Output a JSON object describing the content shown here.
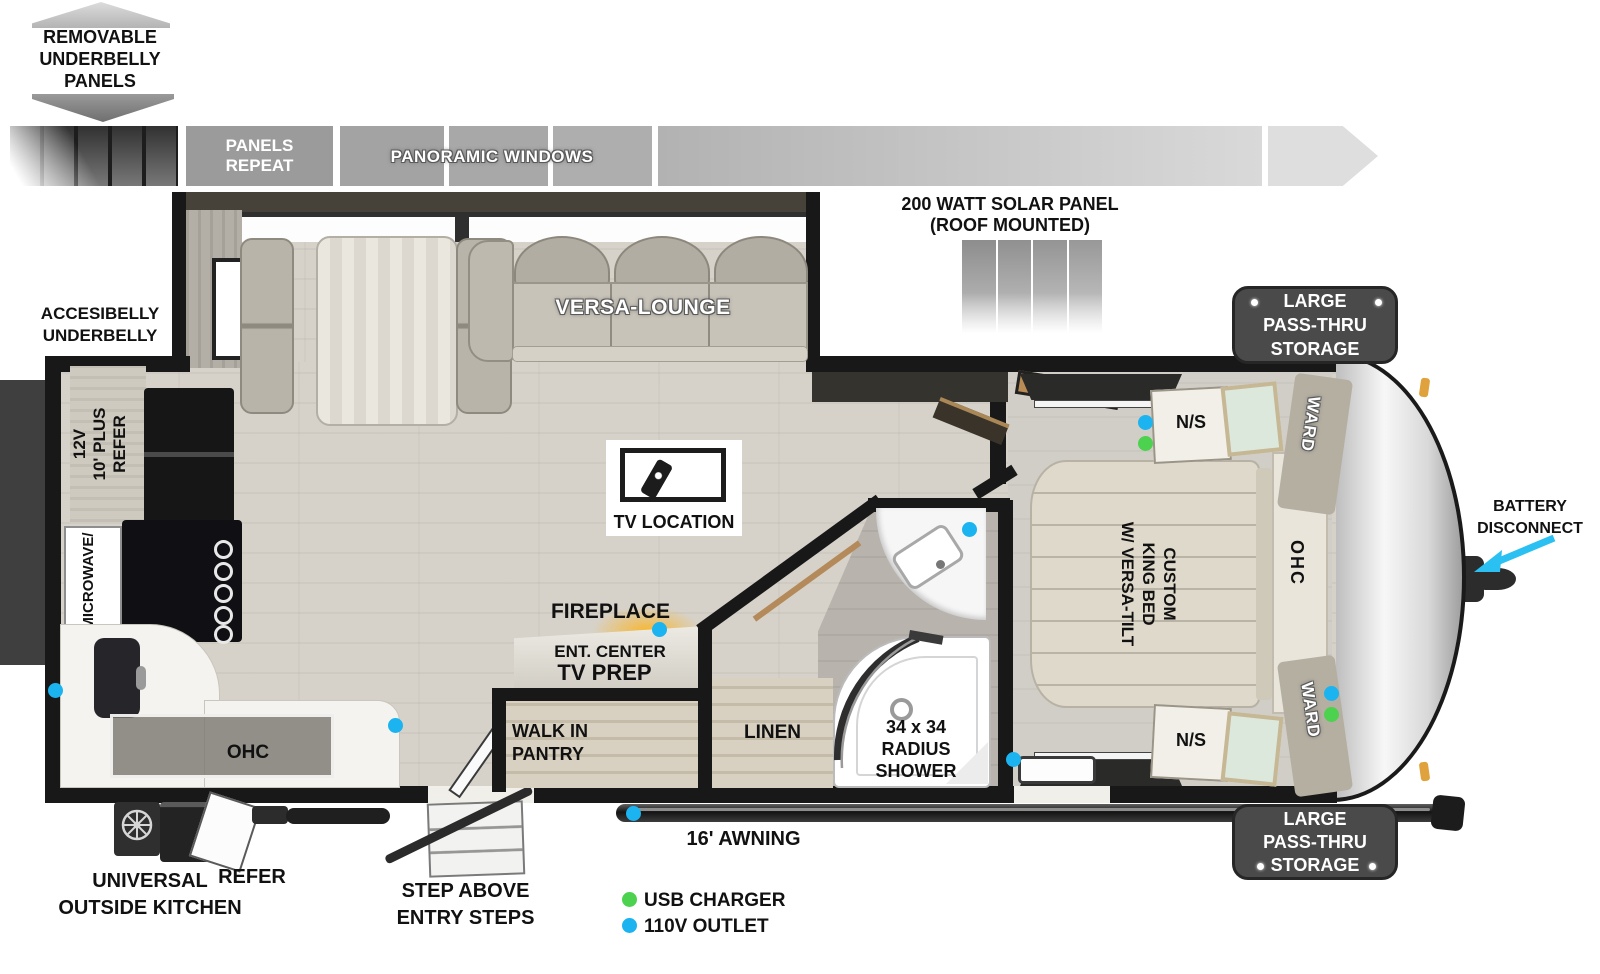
{
  "callouts": {
    "removable": [
      "REMOVABLE",
      "UNDERBELLY",
      "PANELS"
    ],
    "accesibelly": [
      "ACCESIBELLY",
      "UNDERBELLY"
    ],
    "solar": [
      "200 WATT SOLAR PANEL",
      "(ROOF MOUNTED)"
    ],
    "battery": [
      "BATTERY",
      "DISCONNECT"
    ],
    "panels_repeat": [
      "PANELS",
      "REPEAT"
    ],
    "panoramic": "PANORAMIC WINDOWS",
    "awning": "16' AWNING",
    "step": [
      "STEP ABOVE",
      "ENTRY STEPS"
    ],
    "outside_kitchen": [
      "UNIVERSAL",
      "OUTSIDE KITCHEN"
    ],
    "outside_refer": "REFER",
    "storage": [
      "LARGE",
      "PASS-THRU",
      "STORAGE"
    ]
  },
  "rooms": {
    "versa_lounge": "VERSA-LOUNGE",
    "tv_location": "TV LOCATION",
    "fireplace": "FIREPLACE",
    "ent_center": "ENT. CENTER",
    "tv_prep": "TV PREP",
    "pantry": [
      "WALK IN",
      "PANTRY"
    ],
    "linen": "LINEN",
    "shower": [
      "34 x 34",
      "RADIUS",
      "SHOWER"
    ],
    "bed": [
      "CUSTOM",
      "KING BED",
      "W/ VERSA-TILT"
    ],
    "ns": "N/S",
    "ward": "WARD",
    "ohc": "OHC",
    "refer": [
      "12V",
      "10' PLUS",
      "REFER"
    ],
    "microwave": "MICROWAVE/"
  },
  "legend": {
    "usb_label": "USB CHARGER",
    "usb_color": "#4cd24f",
    "outlet_label": "110V OUTLET",
    "outlet_color": "#1cb4f0"
  }
}
